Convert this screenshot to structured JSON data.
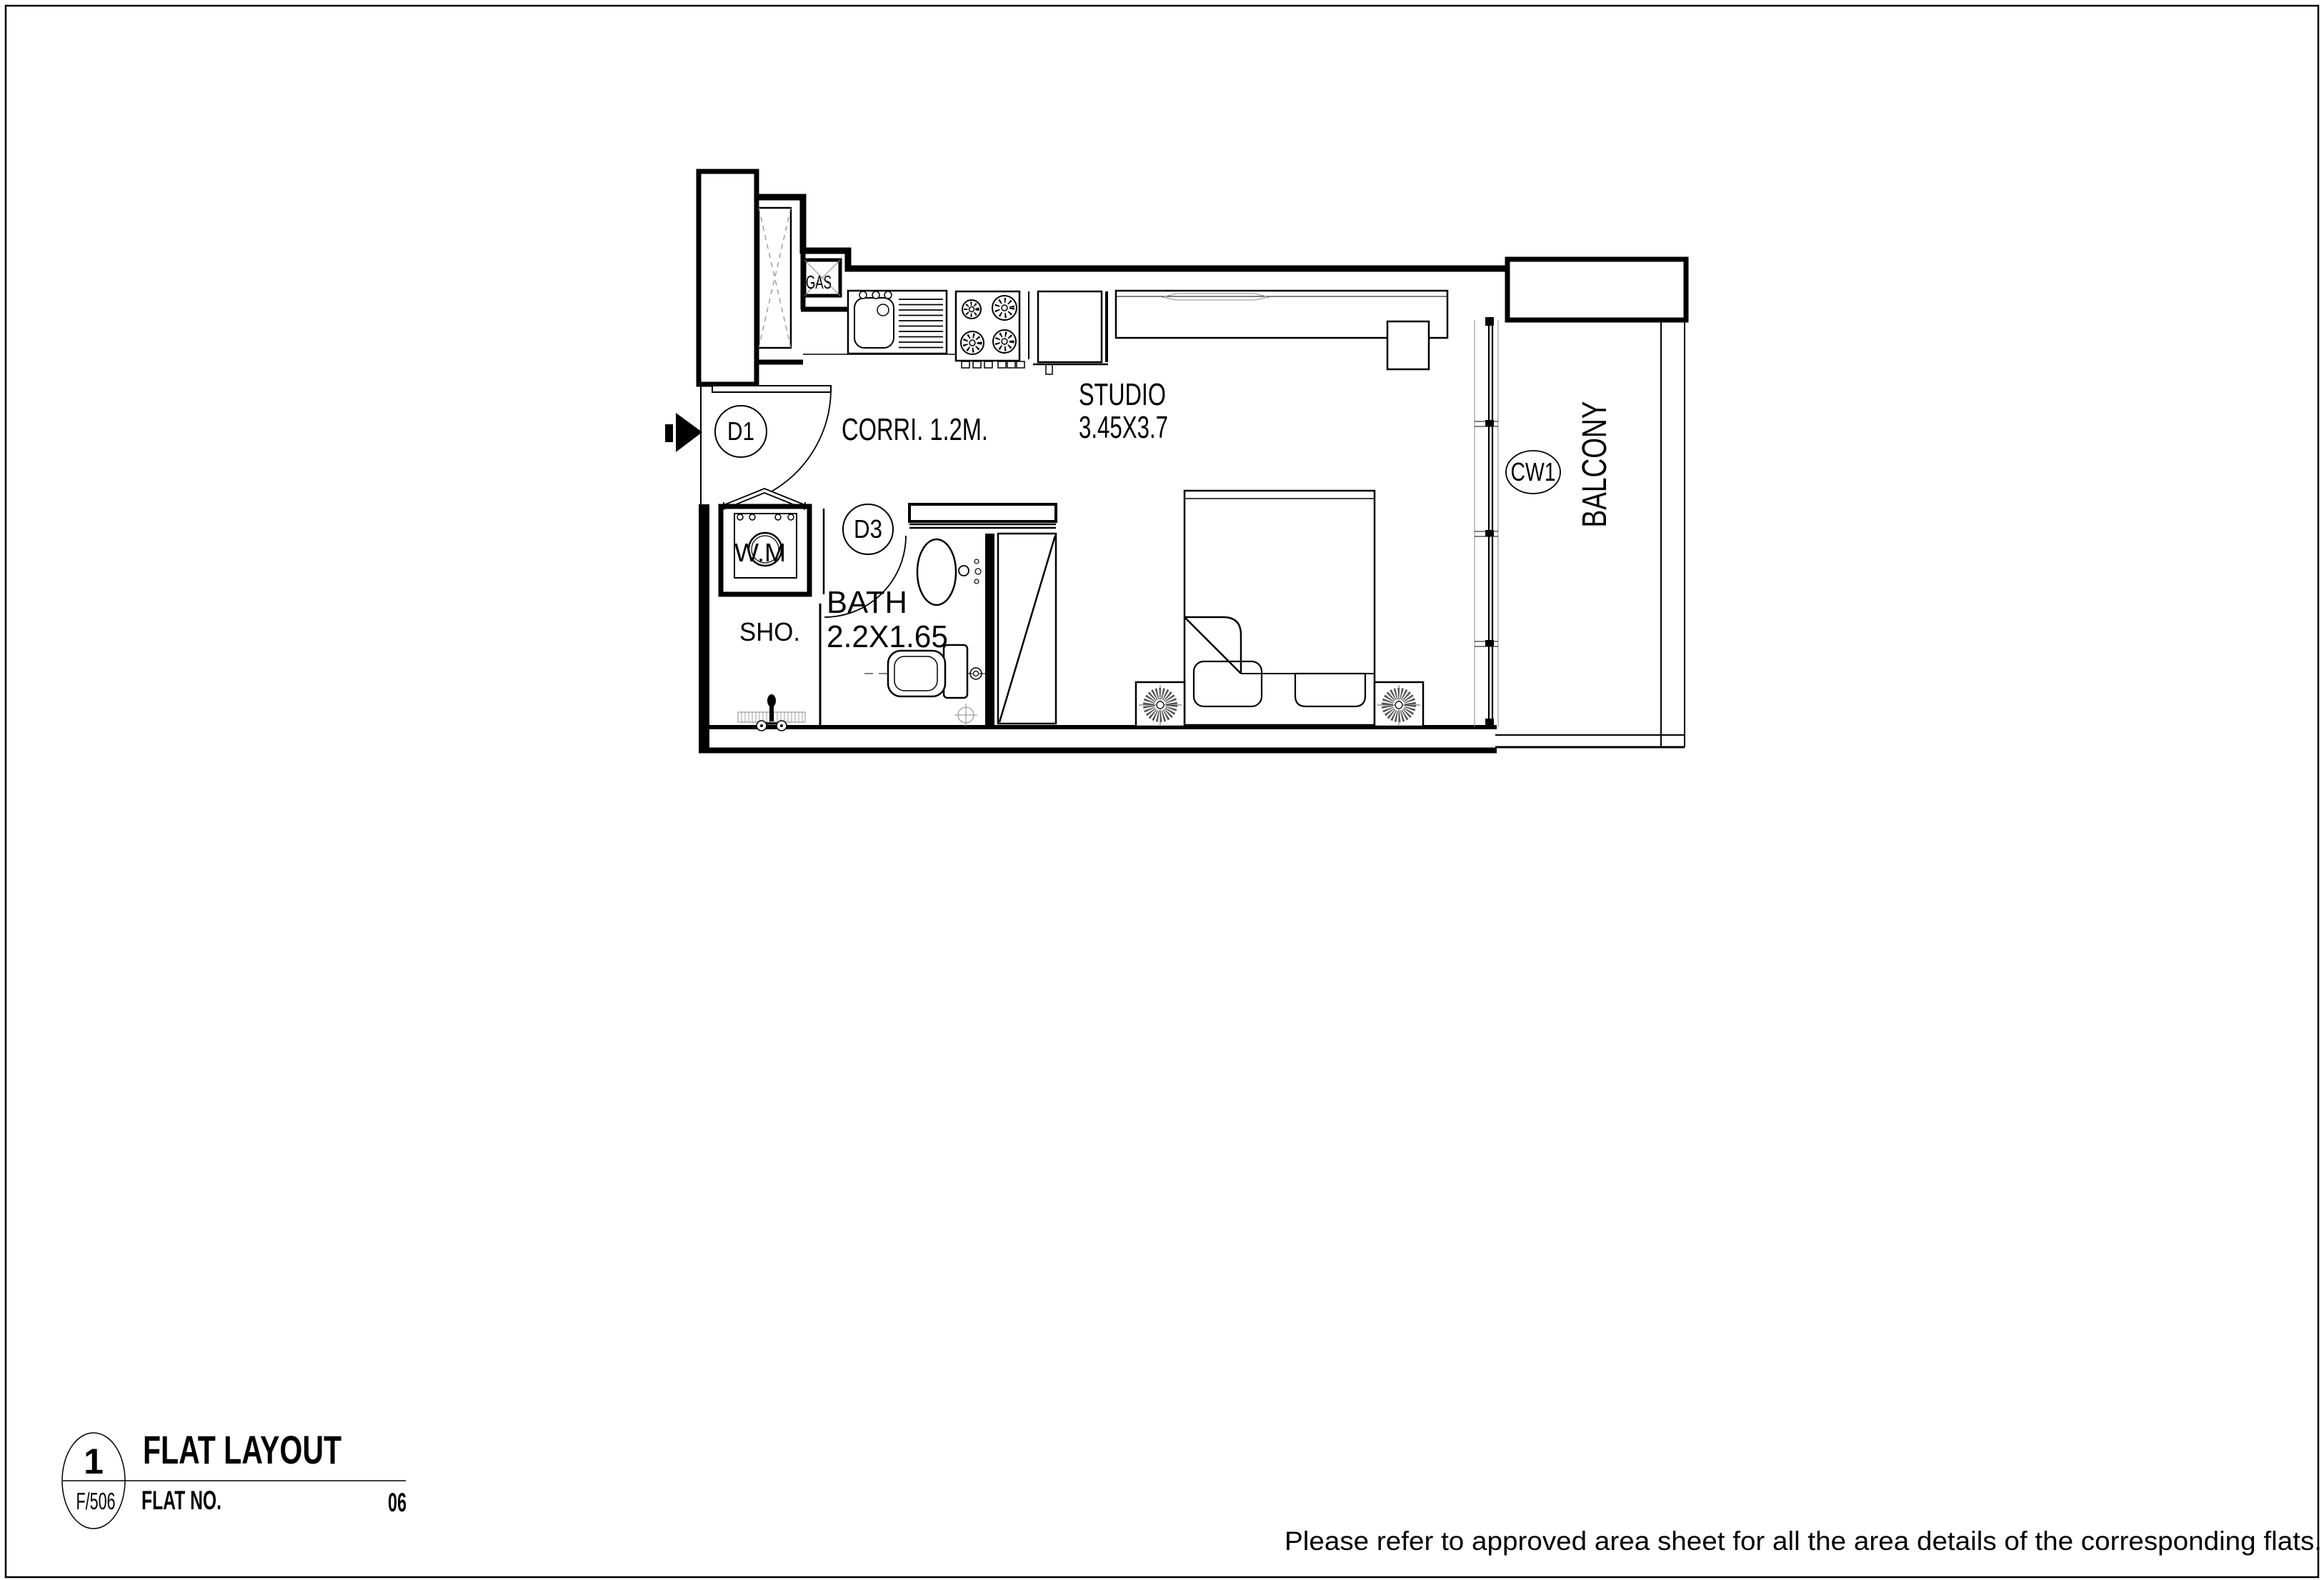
{
  "plan": {
    "rooms": {
      "corridor_label": "CORRI. 1.2M.",
      "studio_label": "STUDIO",
      "studio_dim": "3.45X3.7",
      "bath_label": "BATH",
      "bath_dim": "2.2X1.65",
      "shower_label": "SHO.",
      "washing_machine_label": "W.M",
      "balcony_label": "BALCONY",
      "gas_label": "GAS"
    },
    "tags": {
      "entry_door": "D1",
      "bath_door": "D3",
      "curtain_wall": "CW1"
    }
  },
  "title_block": {
    "detail_number": "1",
    "sheet_ref": "F/506",
    "title": "FLAT LAYOUT",
    "flat_no_label": "FLAT NO.",
    "flat_no_value": "06"
  },
  "footer": {
    "note": "Please refer to approved area sheet for all the area details of the corresponding flats."
  },
  "colors": {
    "line": "#000000",
    "light_line": "#888888",
    "background": "#ffffff"
  }
}
